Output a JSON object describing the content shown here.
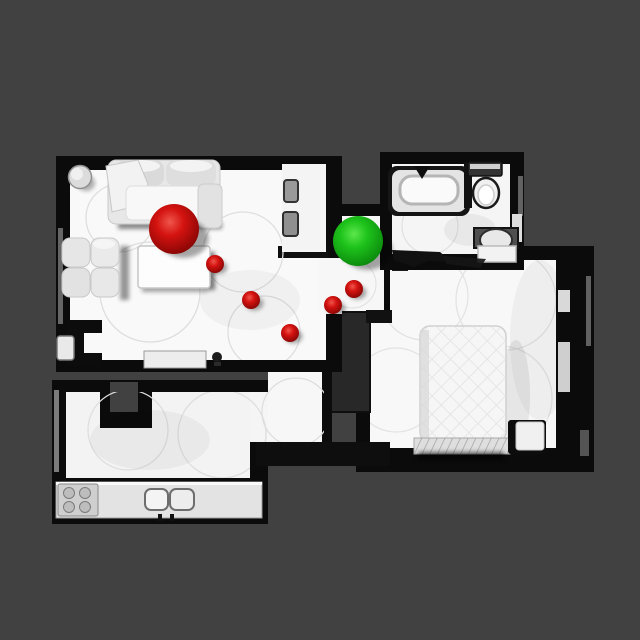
{
  "scene": {
    "description": "top-down render of a 3d-scanned apartment floor plan with navigation markers",
    "background_color": "#414141",
    "wall_color": "#0b0b0b",
    "floor_color": "#f8f8f8",
    "rooms": [
      "living-room",
      "hallway",
      "bathroom",
      "bedroom",
      "kitchen"
    ]
  },
  "markers": {
    "start": {
      "name": "start-sphere-red",
      "x": 174,
      "y": 229,
      "r": 25,
      "color": "#d41310"
    },
    "goal": {
      "name": "goal-sphere-green",
      "x": 358,
      "y": 241,
      "r": 25,
      "color": "#1ec31b"
    },
    "waypoint_color": "#d41310",
    "waypoints": [
      {
        "x": 215,
        "y": 264,
        "r": 9
      },
      {
        "x": 251,
        "y": 300,
        "r": 9
      },
      {
        "x": 290,
        "y": 333,
        "r": 9
      },
      {
        "x": 333,
        "y": 305,
        "r": 9
      },
      {
        "x": 354,
        "y": 289,
        "r": 9
      }
    ]
  }
}
